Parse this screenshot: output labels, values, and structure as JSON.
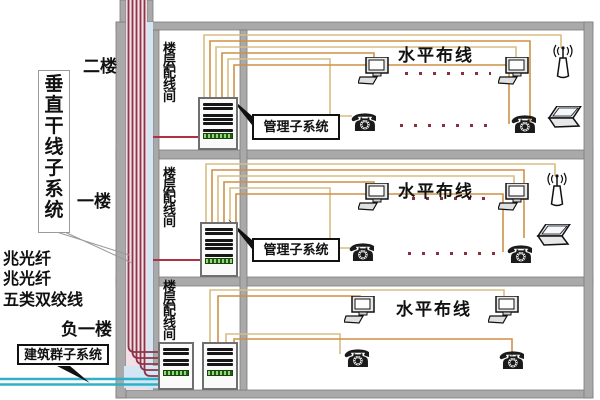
{
  "left_panel": {
    "backbone_label": "垂直干线子系统",
    "floor_labels": [
      "二楼",
      "一楼",
      "负一楼"
    ],
    "fiber_label_1": "兆光纤",
    "fiber_label_2": "兆光纤",
    "utp_label": "五类双绞线",
    "campus_label": "建筑群子系统"
  },
  "floors": [
    {
      "name": "二楼",
      "closet_label": "楼层配线间",
      "management_label": "管理子系统",
      "horizontal_label": "水平布线"
    },
    {
      "name": "一楼",
      "closet_label": "楼层配线间",
      "management_label": "管理子系统",
      "horizontal_label": "水平布线"
    },
    {
      "name": "负一楼",
      "closet_label": "楼层配线间",
      "horizontal_label": "水平布线"
    }
  ],
  "colors": {
    "wall_gray": "#a9a9a9",
    "shaft_pink": "#f2e0e6",
    "duct_blue": "#d4e6f4",
    "backbone_red": "#8e3348",
    "connector_red": "#b03045",
    "campus_cyan": "#2fb0c6",
    "cable_tan": "#d9bd84",
    "cable_orange": "#cd9147",
    "dot_red": "#8b2f3f",
    "rack_green": "#205c16"
  }
}
